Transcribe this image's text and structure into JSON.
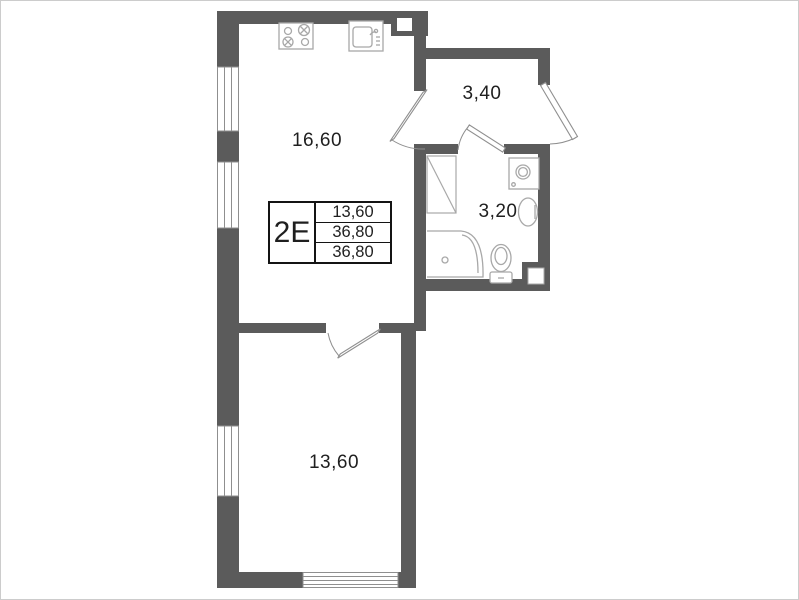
{
  "plan": {
    "legend": {
      "unit_type": "2E",
      "values": [
        "13,60",
        "36,80",
        "36,80"
      ]
    },
    "rooms": [
      {
        "name": "kitchen-living-room",
        "area": "16,60"
      },
      {
        "name": "hallway",
        "area": "3,40"
      },
      {
        "name": "bathroom",
        "area": "3,20"
      },
      {
        "name": "bedroom",
        "area": "13,60"
      }
    ],
    "fixtures": [
      "stove-icon",
      "kitchen-sink-icon",
      "washing-machine-icon",
      "bathroom-sink-icon",
      "toilet-icon",
      "shower-tray-icon",
      "duct-shaft-icon",
      "vent-notch-icon"
    ],
    "colors": {
      "wall": "#5b5b5b",
      "fixture_line": "#a8a8a8",
      "door_line": "#8f8f8f",
      "window_line": "#8f8f8f",
      "label_text": "#1f1f1f",
      "background": "#ffffff",
      "frame_border": "#cccccc"
    }
  }
}
